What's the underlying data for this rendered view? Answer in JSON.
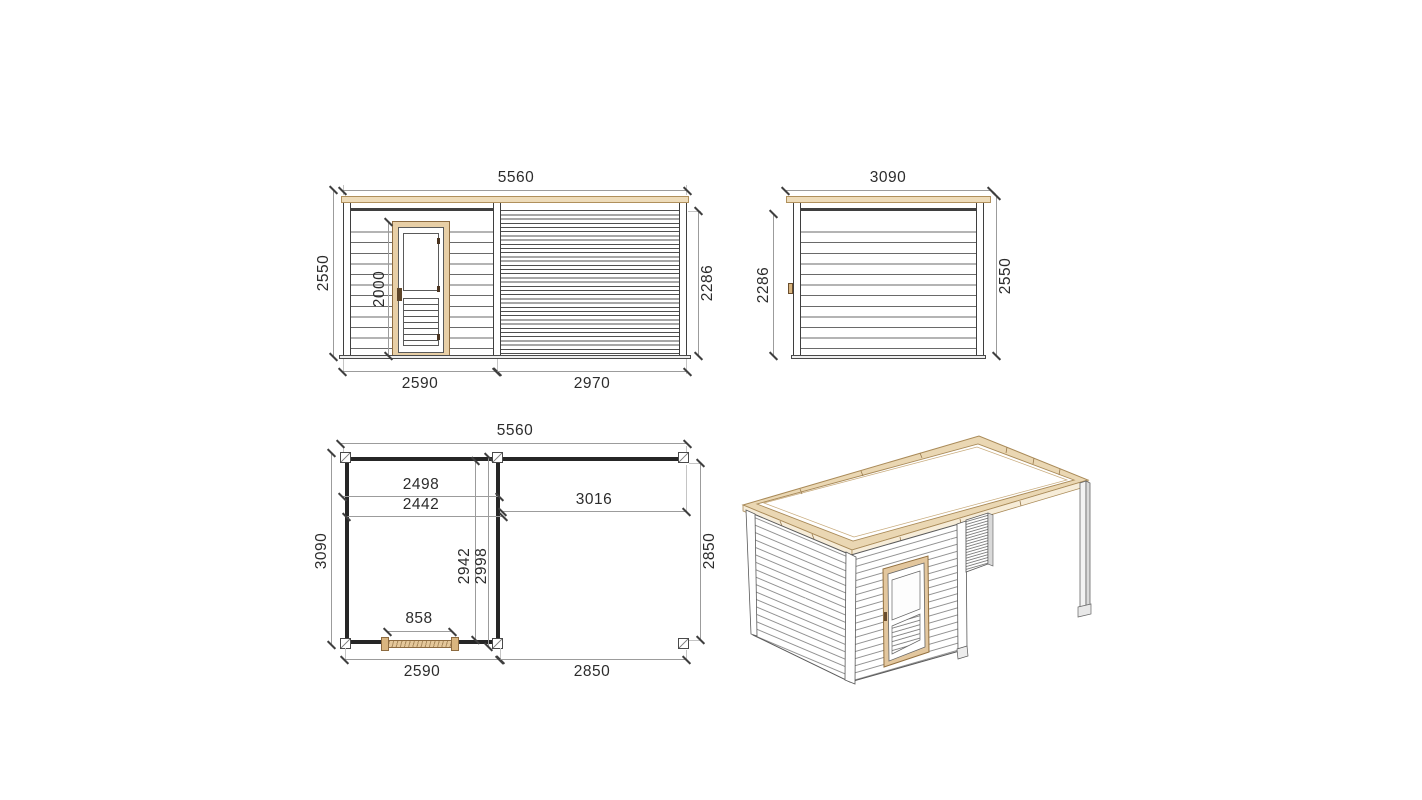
{
  "drawing_title": "garden-cabin-technical-drawing",
  "colors": {
    "wood_accent": "#e8cfa6",
    "wood_line": "#8d6b40",
    "fascia_fill": "#eedcba",
    "line_dark": "#3f3f3f",
    "dim_line": "#9c9c9c",
    "text": "#2c2c2c",
    "background": "#ffffff"
  },
  "front_elevation": {
    "width_total": "5560",
    "height_overall": "2550",
    "door_height": "2000",
    "wall_height": "2286",
    "cabin_width": "2590",
    "annex_width": "2970"
  },
  "side_elevation": {
    "width_total": "3090",
    "wall_height": "2286",
    "height_overall": "2550"
  },
  "floor_plan": {
    "width_total": "5560",
    "depth_overall": "3090",
    "inner_width_to_wall": "2498",
    "inner_width": "2442",
    "annex_inner_width": "3016",
    "inner_depth": "2942",
    "inner_depth_to_wall": "2998",
    "door_width": "858",
    "annex_depth": "2850",
    "cabin_width": "2590",
    "annex_width": "2850"
  }
}
